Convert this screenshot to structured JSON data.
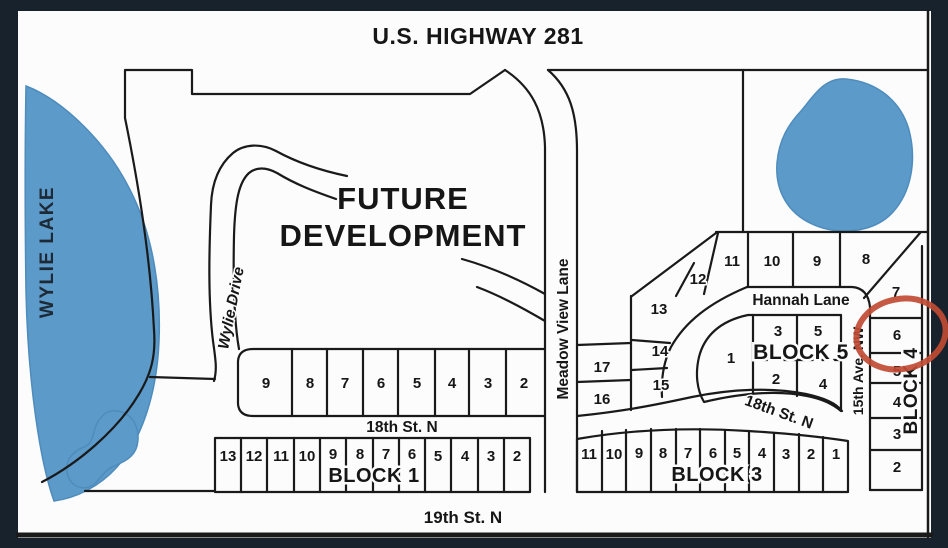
{
  "map": {
    "highway_label": "U.S. HIGHWAY 281",
    "lake_label": "WYLIE LAKE",
    "future_development": {
      "line1": "FUTURE",
      "line2": "DEVELOPMENT"
    },
    "streets": {
      "wylie_drive": "Wylie Drive",
      "meadow_view_lane": "Meadow View Lane",
      "hannah_lane": "Hannah Lane",
      "st18_west": "18th St. N",
      "st18_east": "18th St. N",
      "st19": "19th St. N",
      "ave15": "15th Ave. NW"
    },
    "row18": {
      "lots": [
        "9",
        "8",
        "7",
        "6",
        "5",
        "4",
        "3",
        "2"
      ]
    },
    "block1": {
      "label": "BLOCK 1",
      "lots": [
        "13",
        "12",
        "11",
        "10",
        "9",
        "8",
        "7",
        "6",
        "5",
        "4",
        "3",
        "2"
      ]
    },
    "block3": {
      "label": "BLOCK 3",
      "lots": [
        "11",
        "10",
        "9",
        "8",
        "7",
        "6",
        "5",
        "4",
        "3",
        "2",
        "1"
      ]
    },
    "block4": {
      "label": "BLOCK 4",
      "lot_top": "8",
      "lots_column": [
        "7",
        "6",
        "5",
        "4",
        "3",
        "2"
      ],
      "circled_lot": "6"
    },
    "block5": {
      "label": "BLOCK 5",
      "lot_left": "1",
      "lots_top": [
        "3",
        "5"
      ],
      "lots_bottom": [
        "2",
        "4"
      ]
    },
    "north_row_lots": [
      "11",
      "10",
      "9"
    ],
    "west_cluster_lots": [
      "12",
      "13",
      "14",
      "15"
    ],
    "meadow_lots": [
      "17",
      "16"
    ],
    "colors": {
      "water": "#5b9ac9",
      "line": "#1a1a1a",
      "highlight_circle": "#c04b33",
      "frame": "#18222c"
    }
  }
}
